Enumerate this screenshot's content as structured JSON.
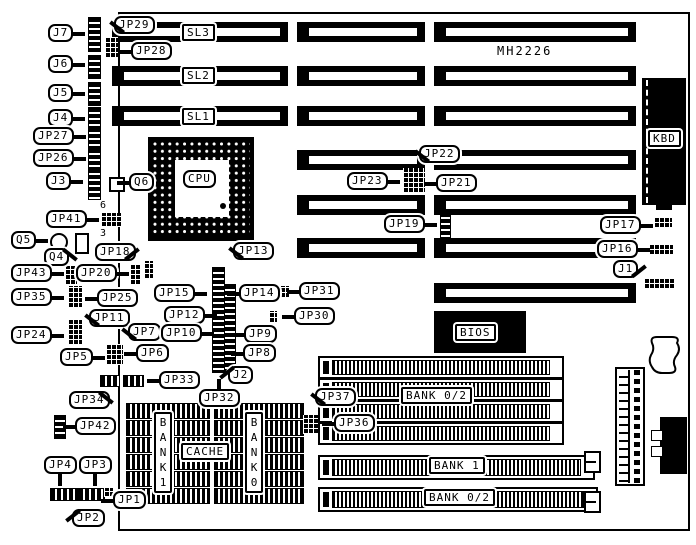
{
  "board": {
    "part_number": "MH2226"
  },
  "slots": {
    "sl3": "SL3",
    "sl2": "SL2",
    "sl1": "SL1"
  },
  "components": {
    "cpu": "CPU",
    "bios": "BIOS",
    "kbd": "KBD",
    "cache": "CACHE",
    "bank1_column": "BANK1",
    "bank0_column": "BANK0",
    "bank02_simm_top": "BANK 0/2",
    "bank1_simm": "BANK 1",
    "bank02_simm_bottom": "BANK 0/2"
  },
  "pin_numbers": {
    "jp41_top": "6",
    "jp41_bottom": "3"
  },
  "callouts": {
    "j1": "J1",
    "j2": "J2",
    "j3": "J3",
    "j4": "J4",
    "j5": "J5",
    "j6": "J6",
    "j7": "J7",
    "q4": "Q4",
    "q5": "Q5",
    "q6": "Q6",
    "jp1": "JP1",
    "jp2": "JP2",
    "jp3": "JP3",
    "jp4": "JP4",
    "jp5": "JP5",
    "jp6": "JP6",
    "jp7": "JP7",
    "jp8": "JP8",
    "jp9": "JP9",
    "jp10": "JP10",
    "jp11": "JP11",
    "jp12": "JP12",
    "jp13": "JP13",
    "jp14": "JP14",
    "jp15": "JP15",
    "jp16": "JP16",
    "jp17": "JP17",
    "jp18": "JP18",
    "jp19": "JP19",
    "jp20": "JP20",
    "jp21": "JP21",
    "jp22": "JP22",
    "jp23": "JP23",
    "jp24": "JP24",
    "jp25": "JP25",
    "jp26": "JP26",
    "jp27": "JP27",
    "jp28": "JP28",
    "jp29": "JP29",
    "jp30": "JP30",
    "jp31": "JP31",
    "jp32": "JP32",
    "jp33": "JP33",
    "jp34": "JP34",
    "jp35": "JP35",
    "jp36": "JP36",
    "jp37": "JP37",
    "jp41": "JP41",
    "jp42": "JP42",
    "jp43": "JP43"
  }
}
